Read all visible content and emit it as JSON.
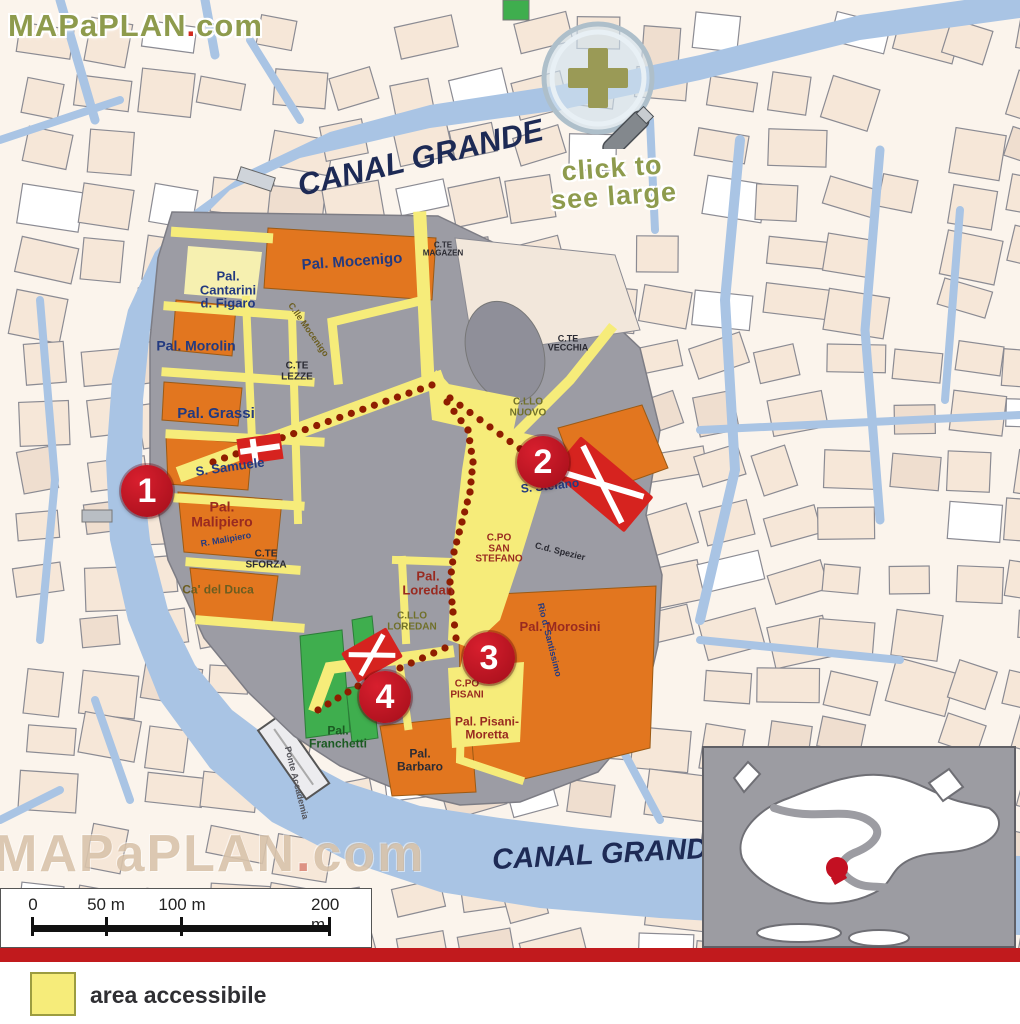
{
  "brand": {
    "name": "MAPaPLAN",
    "dot": ".",
    "tld": "com"
  },
  "magnifier": {
    "line1": "click to",
    "line2": "see large"
  },
  "canal_labels": {
    "top": "CANAL GRANDE",
    "bottom": "CANAL GRANDE"
  },
  "markers": [
    {
      "label": "1",
      "x": 147,
      "y": 491
    },
    {
      "label": "2",
      "x": 543,
      "y": 462
    },
    {
      "label": "3",
      "x": 489,
      "y": 658
    },
    {
      "label": "4",
      "x": 385,
      "y": 697
    }
  ],
  "labels": [
    {
      "text": "Pal. Mocenigo",
      "x": 352,
      "y": 262,
      "size": 15,
      "color": "navy",
      "rot": -4
    },
    {
      "text": "Pal.\nCantarini\nd. Figaro",
      "x": 228,
      "y": 290,
      "size": 13,
      "color": "navy",
      "rot": 0
    },
    {
      "text": "Pal. Morolin",
      "x": 196,
      "y": 346,
      "size": 14,
      "color": "navy",
      "rot": 0
    },
    {
      "text": "Pal. Grassi",
      "x": 216,
      "y": 414,
      "size": 15,
      "color": "navy",
      "rot": 0
    },
    {
      "text": "C.TE\nLEZZE",
      "x": 297,
      "y": 372,
      "size": 10,
      "color": "dark",
      "rot": 0
    },
    {
      "text": "S. Samuele",
      "x": 230,
      "y": 467,
      "size": 13,
      "color": "navy",
      "rot": -8
    },
    {
      "text": "Pal.\nMalipiero",
      "x": 222,
      "y": 514,
      "size": 14,
      "color": "maroon",
      "rot": 0
    },
    {
      "text": "R. Malipiero",
      "x": 226,
      "y": 540,
      "size": 9,
      "color": "navy",
      "rot": -10
    },
    {
      "text": "C.TE\nSFORZA",
      "x": 266,
      "y": 560,
      "size": 10,
      "color": "dark",
      "rot": 0
    },
    {
      "text": "Ca' del Duca",
      "x": 218,
      "y": 590,
      "size": 12,
      "color": "olive",
      "rot": 0
    },
    {
      "text": "C.TE\nMAGAZEN",
      "x": 443,
      "y": 250,
      "size": 8,
      "color": "dark",
      "rot": 0
    },
    {
      "text": "C.TE\nVECCHIA",
      "x": 568,
      "y": 344,
      "size": 9,
      "color": "dark",
      "rot": 0
    },
    {
      "text": "C.LLO\nNUOVO",
      "x": 528,
      "y": 408,
      "size": 10,
      "color": "oliveDark",
      "rot": 0
    },
    {
      "text": "S. Stefano",
      "x": 550,
      "y": 486,
      "size": 12,
      "color": "navy",
      "rot": -6
    },
    {
      "text": "C.PO\nSAN\nSTEFANO",
      "x": 499,
      "y": 549,
      "size": 10,
      "color": "maroon",
      "rot": 0
    },
    {
      "text": "C.d. Spezier",
      "x": 560,
      "y": 552,
      "size": 9,
      "color": "dark",
      "rot": 14
    },
    {
      "text": "Pal.\nLoredan",
      "x": 428,
      "y": 583,
      "size": 13,
      "color": "maroon",
      "rot": 0
    },
    {
      "text": "C.LLO\nLOREDAN",
      "x": 412,
      "y": 622,
      "size": 10,
      "color": "oliveDark",
      "rot": 0
    },
    {
      "text": "Pal. Morosini",
      "x": 560,
      "y": 627,
      "size": 13,
      "color": "maroon",
      "rot": 0
    },
    {
      "text": "C.PO\nPISANI",
      "x": 467,
      "y": 690,
      "size": 10,
      "color": "maroon",
      "rot": 0
    },
    {
      "text": "Pal. Pisani-\nMoretta",
      "x": 487,
      "y": 728,
      "size": 12,
      "color": "maroon",
      "rot": 0
    },
    {
      "text": "Pal.\nFranchetti",
      "x": 338,
      "y": 737,
      "size": 12,
      "color": "green",
      "rot": 0
    },
    {
      "text": "Pal.\nBarbaro",
      "x": 420,
      "y": 760,
      "size": 12,
      "color": "dark",
      "rot": 0
    },
    {
      "text": "Rio d. Santissimo",
      "x": 549,
      "y": 640,
      "size": 9,
      "color": "navy",
      "rot": 76
    },
    {
      "text": "Ponte Accademia",
      "x": 296,
      "y": 783,
      "size": 9,
      "color": "gray",
      "rot": 76
    },
    {
      "text": "C.lle Mocenigo",
      "x": 308,
      "y": 330,
      "size": 9,
      "color": "olive",
      "rot": 55
    }
  ],
  "colors": {
    "navy": "#233a80",
    "maroon": "#992a20",
    "dark": "#2b2b33",
    "olive": "#6b5d20",
    "oliveDark": "#70702a",
    "green": "#1b5a22",
    "gray": "#54545a",
    "water": "#a9c4e4",
    "accessible": "#f6ec7a",
    "landmark": "#e2761f",
    "marker_red": "#c1121f",
    "route_dot": "#8f1d00",
    "band_red": "#c11a1d"
  },
  "route": {
    "polylines": [
      [
        [
          213,
          462
        ],
        [
          432,
          385
        ]
      ],
      [
        [
          450,
          398
        ],
        [
          530,
          456
        ]
      ],
      [
        [
          447,
          402
        ],
        [
          468,
          430
        ],
        [
          473,
          462
        ],
        [
          470,
          492
        ],
        [
          462,
          522
        ],
        [
          454,
          552
        ],
        [
          450,
          582
        ],
        [
          453,
          612
        ],
        [
          456,
          638
        ]
      ],
      [
        [
          445,
          648
        ],
        [
          400,
          668
        ]
      ],
      [
        [
          368,
          680
        ],
        [
          318,
          710
        ]
      ]
    ]
  },
  "scale_bar": {
    "ticks": [
      "0",
      "50 m",
      "100 m",
      "200 m"
    ]
  },
  "legend": {
    "label": "area accessibile"
  }
}
